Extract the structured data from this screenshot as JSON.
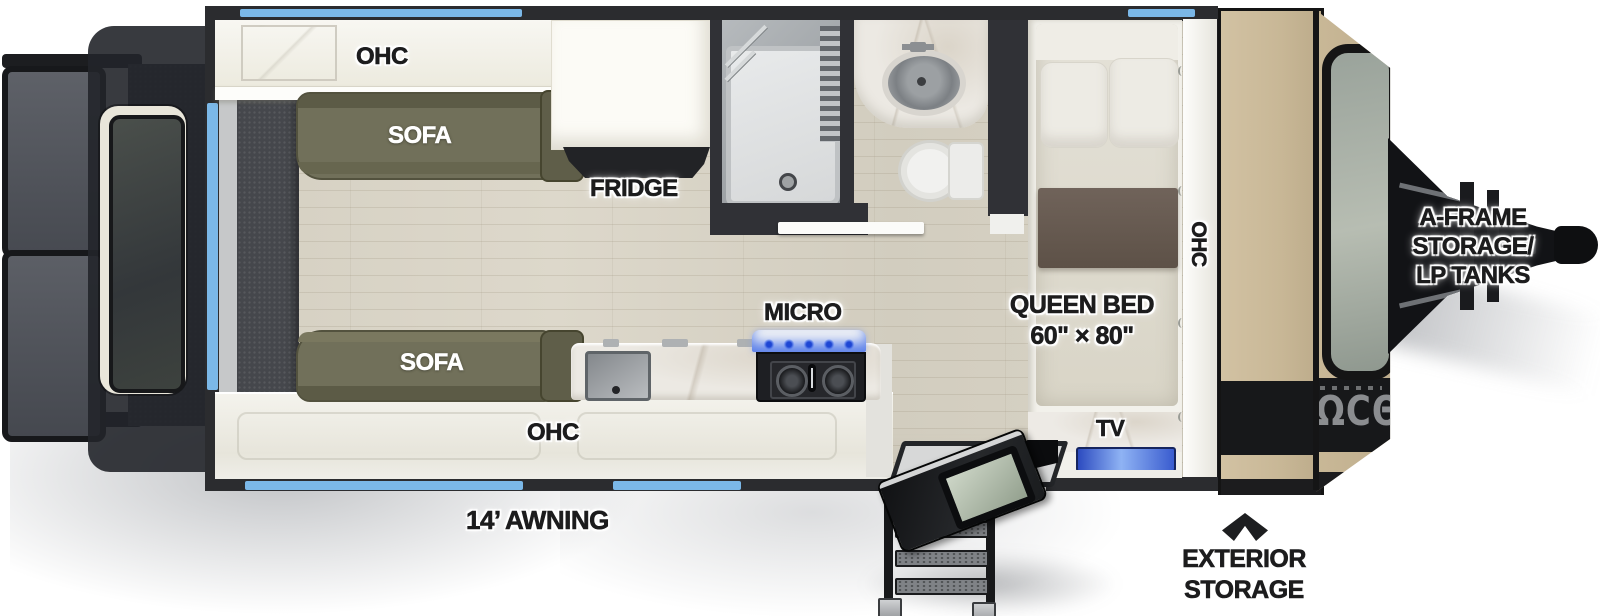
{
  "title": "Travel trailer floor plan",
  "labels": {
    "ohc_top": "OHC",
    "sofa_top": "SOFA",
    "fridge": "FRIDGE",
    "micro": "MICRO",
    "sofa_bottom": "SOFA",
    "ohc_bottom": "OHC",
    "ohc_front": "OHC",
    "queen_bed": [
      "QUEEN BED",
      "60\" × 80\""
    ],
    "tv": "TV",
    "awning": "14’ AWNING",
    "aframe": [
      "A-FRAME",
      "STORAGE/",
      "LP TANKS"
    ],
    "exterior_storage": [
      "EXTERIOR",
      "STORAGE"
    ],
    "brand_glyphs": "ΩCΘU"
  },
  "icons": {
    "exterior_storage_pointer": "chevron-up-icon"
  },
  "colors": {
    "accent_blue": "#7bb8e8",
    "wall_dark": "#2b2c2f",
    "floor_wood": "#d8d3c6",
    "cabinet_white": "#f4f3ee",
    "sofa_olive": "#71705a",
    "front_cap_tan": "#cabb9b",
    "logo_band_black": "#17181a",
    "tv_blue": "#4a6ede",
    "label_dark": "#1c1c1d",
    "label_white": "#ffffff"
  }
}
